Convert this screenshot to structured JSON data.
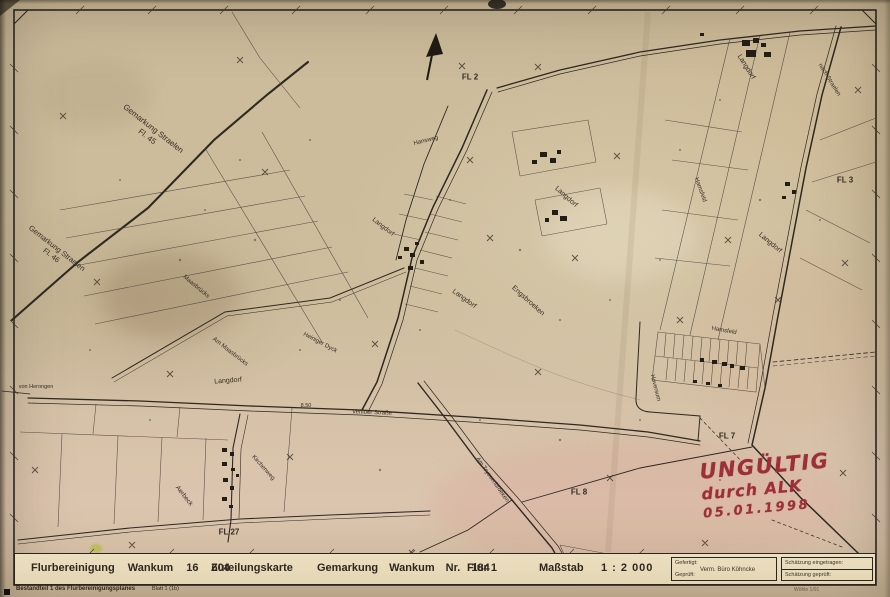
{
  "title_band": {
    "flurbereinigung": "Flurbereinigung Wankum 16 604",
    "zuteilungskarte": "Zuteilungskarte",
    "gemarkung": "Gemarkung Wankum Nr. 184",
    "flur": "Flur 1",
    "massstab_label": "Maßstab",
    "massstab_value": "1 : 2 000",
    "gefertigt_label": "Gefertigt:",
    "gefertigt_value": "Verm. Büro Köhncke",
    "geprueft_label": "Geprüft:",
    "schaetzung_eingetragen": "Schätzung eingetragen:",
    "schaetzung_geprueft": "Schätzung geprüft:",
    "form_note": "Wöhle 1/91"
  },
  "footer": {
    "bestandteil": "Bestandteil 1 des Flurbereinigungsplanes",
    "blatt": "Blatt 1 (1b)"
  },
  "stamp": {
    "line1": "UNGÜLTIG",
    "line2": "durch ALK",
    "line3": "05.01.1998",
    "color": "#9c2f38"
  },
  "map_labels": {
    "gemarkung_straelen_45_line1": "Gemarkung Straelen",
    "gemarkung_straelen_45_line2": "Fl. 45",
    "gemarkung_straelen_46_line1": "Gemarkung Straelen",
    "gemarkung_straelen_46_line2": "Fl. 46",
    "fl2": "FL 2",
    "fl3": "FL 3",
    "fl7": "FL 7",
    "fl8": "FL 8",
    "fl27": "FL 27",
    "langdorf_top": "Langdorf",
    "nach_straelen": "nach Straelen",
    "hamsfeld_upper": "Hamsfeld",
    "langdorf_right": "Langdorf",
    "langdorf_mid_upper": "Langdorf",
    "langdorf_mid_left": "Langdorf",
    "langdorf_center": "Langdorf",
    "langdorf_lower": "Langdorf",
    "engsbroeken": "Engsbroeken",
    "maasbruecks": "Maasbrücks",
    "am_maasbruecks": "Am Maasbrücks",
    "heiniger_dyck": "Heiniger Dyck",
    "hansweg": "Hansweg",
    "venloer_strasse": "Venloer Straße",
    "road_width": "8.50",
    "aerbeck": "Aerbeck",
    "kirchenweg": "Kirchenweg",
    "am_tryssenbroeken": "Am Tryssenbroeken",
    "hoversum": "Hoversum",
    "hamsfeld_lower": "Hamsfeld",
    "von_herongen": "von Herongen"
  },
  "colors": {
    "paper": "#cdbc9b",
    "ink": "#2e2921",
    "stamp_red": "#9c2f38"
  }
}
